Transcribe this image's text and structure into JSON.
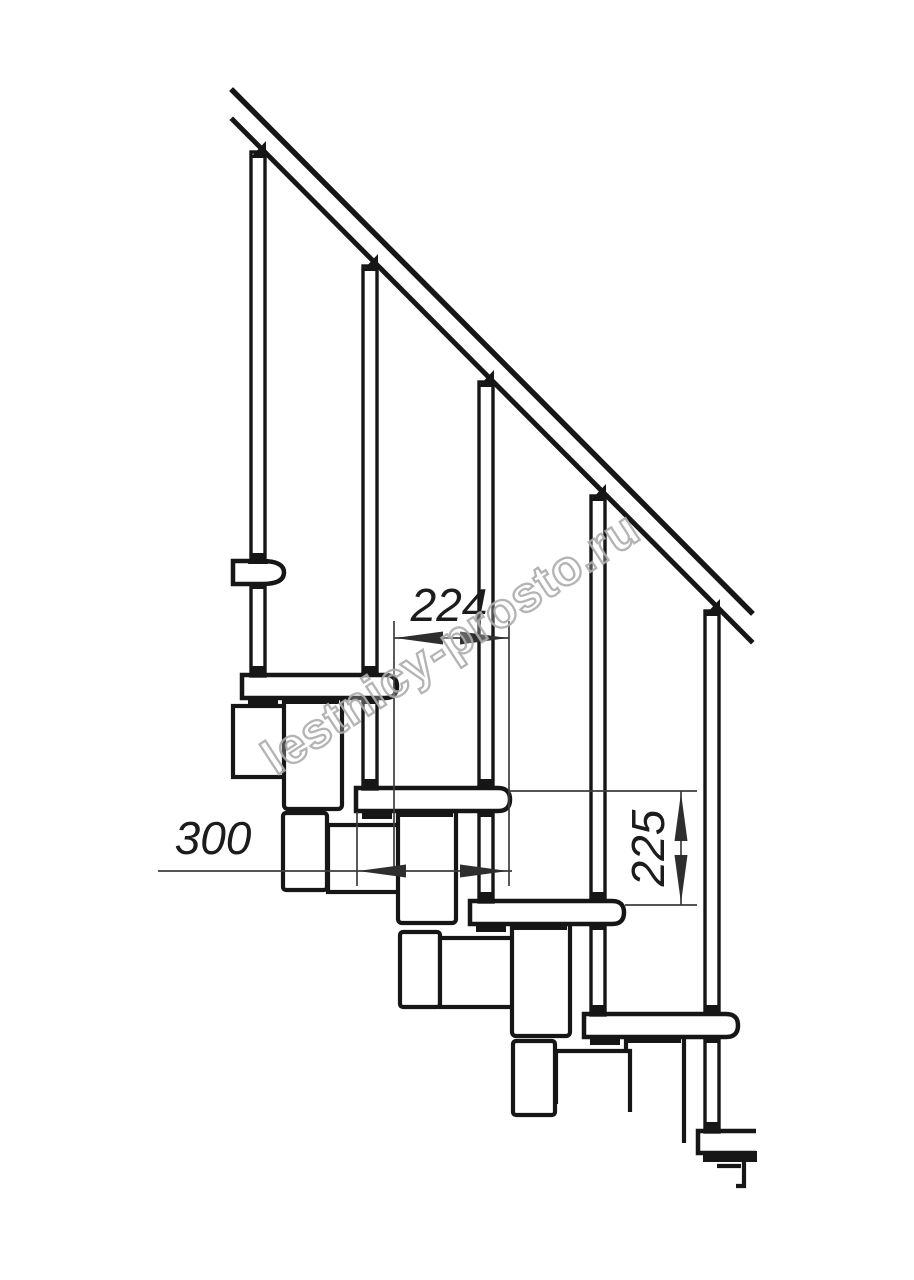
{
  "drawing": {
    "subject": "modular-staircase-side-elevation",
    "colors": {
      "line": "#161616",
      "dimension": "#3d3d3d",
      "background": "#ffffff",
      "watermark": "#acacac"
    },
    "dimensions": {
      "run": {
        "value": "224",
        "orientation": "horizontal"
      },
      "depth": {
        "value": "300",
        "orientation": "horizontal"
      },
      "rise": {
        "value": "225",
        "orientation": "vertical"
      }
    },
    "watermark": {
      "text": "lestnicy-prosto.ru"
    }
  }
}
